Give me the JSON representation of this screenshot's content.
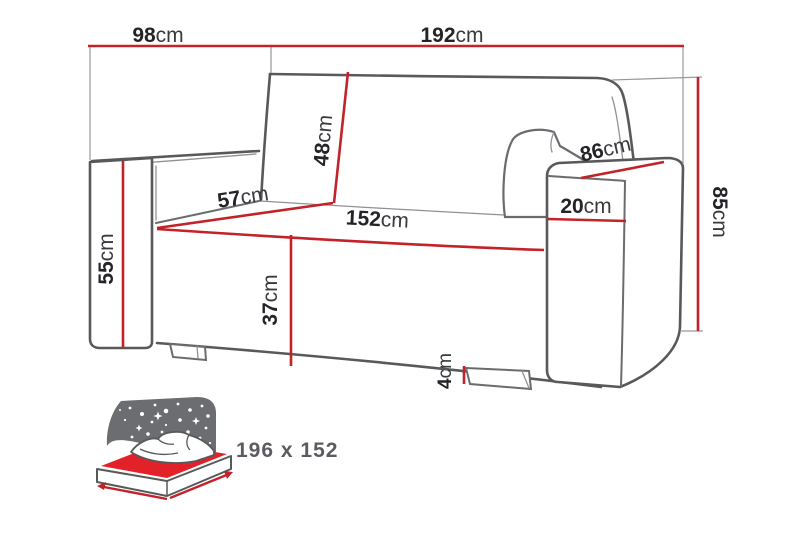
{
  "dimensions": {
    "depth": {
      "value": "98",
      "unit": "cm"
    },
    "width": {
      "value": "192",
      "unit": "cm"
    },
    "backrest_height": {
      "value": "48",
      "unit": "cm"
    },
    "seat_depth": {
      "value": "57",
      "unit": "cm"
    },
    "seat_width": {
      "value": "152",
      "unit": "cm"
    },
    "armrest_top_length": {
      "value": "86",
      "unit": "cm"
    },
    "armrest_width": {
      "value": "20",
      "unit": "cm"
    },
    "armrest_height": {
      "value": "55",
      "unit": "cm"
    },
    "total_height": {
      "value": "85",
      "unit": "cm"
    },
    "seat_height": {
      "value": "37",
      "unit": "cm"
    },
    "leg_height": {
      "value": "4",
      "unit": "cm"
    }
  },
  "bed": {
    "sleeping_area_label": "196 x 152"
  },
  "colors": {
    "dimension_line_red": "#c42229",
    "sofa_outline_grey": "#58595b",
    "label_text": "#242428",
    "bed_headboard_grey": "#6c6d70",
    "bed_mattress_red": "#e32128",
    "bed_label_grey": "#5b5c5f"
  }
}
